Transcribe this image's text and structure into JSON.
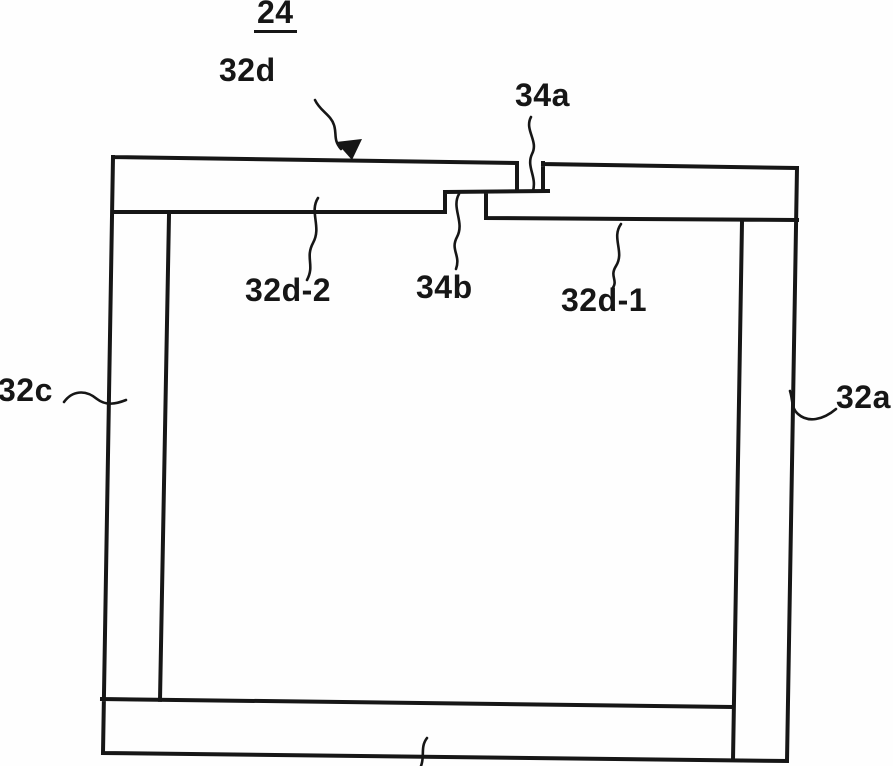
{
  "figure": {
    "title": "24",
    "labels": {
      "top_member": "32d",
      "joint_upper": "34a",
      "top_left_piece": "32d-2",
      "joint_lower": "34b",
      "top_right_piece": "32d-1",
      "left_member": "32c",
      "right_member": "32a"
    },
    "colors": {
      "ink": "#161616",
      "background": "#fefefe"
    }
  }
}
